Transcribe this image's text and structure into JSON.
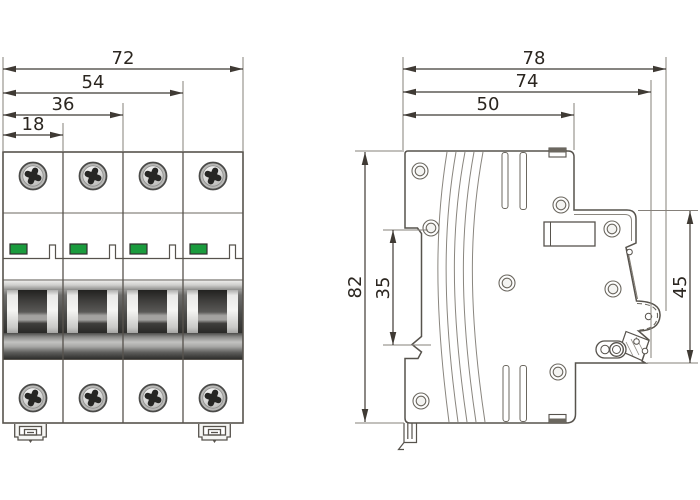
{
  "front_view": {
    "pole_count": 4,
    "width_dimensions": [
      {
        "name": "overall-width",
        "label": "72"
      },
      {
        "name": "three-module-width",
        "label": "54"
      },
      {
        "name": "two-module-width",
        "label": "36"
      },
      {
        "name": "one-module-width",
        "label": "18"
      }
    ],
    "indicator_color": "#1a9b3d"
  },
  "side_view": {
    "depth_dimensions": [
      {
        "name": "overall-depth",
        "label": "78"
      },
      {
        "name": "depth-with-handle",
        "label": "74"
      },
      {
        "name": "upper-body-depth",
        "label": "50"
      }
    ],
    "height_dimensions": [
      {
        "name": "overall-height",
        "label": "82"
      },
      {
        "name": "din-recess-height",
        "label": "35"
      },
      {
        "name": "front-face-height",
        "label": "45"
      }
    ]
  },
  "colors": {
    "background": "#ffffff",
    "outline": "#57534d",
    "dimension_line": "#3f3a34",
    "dimension_text": "#2b2620",
    "indicator_green": "#1a9b3d"
  }
}
